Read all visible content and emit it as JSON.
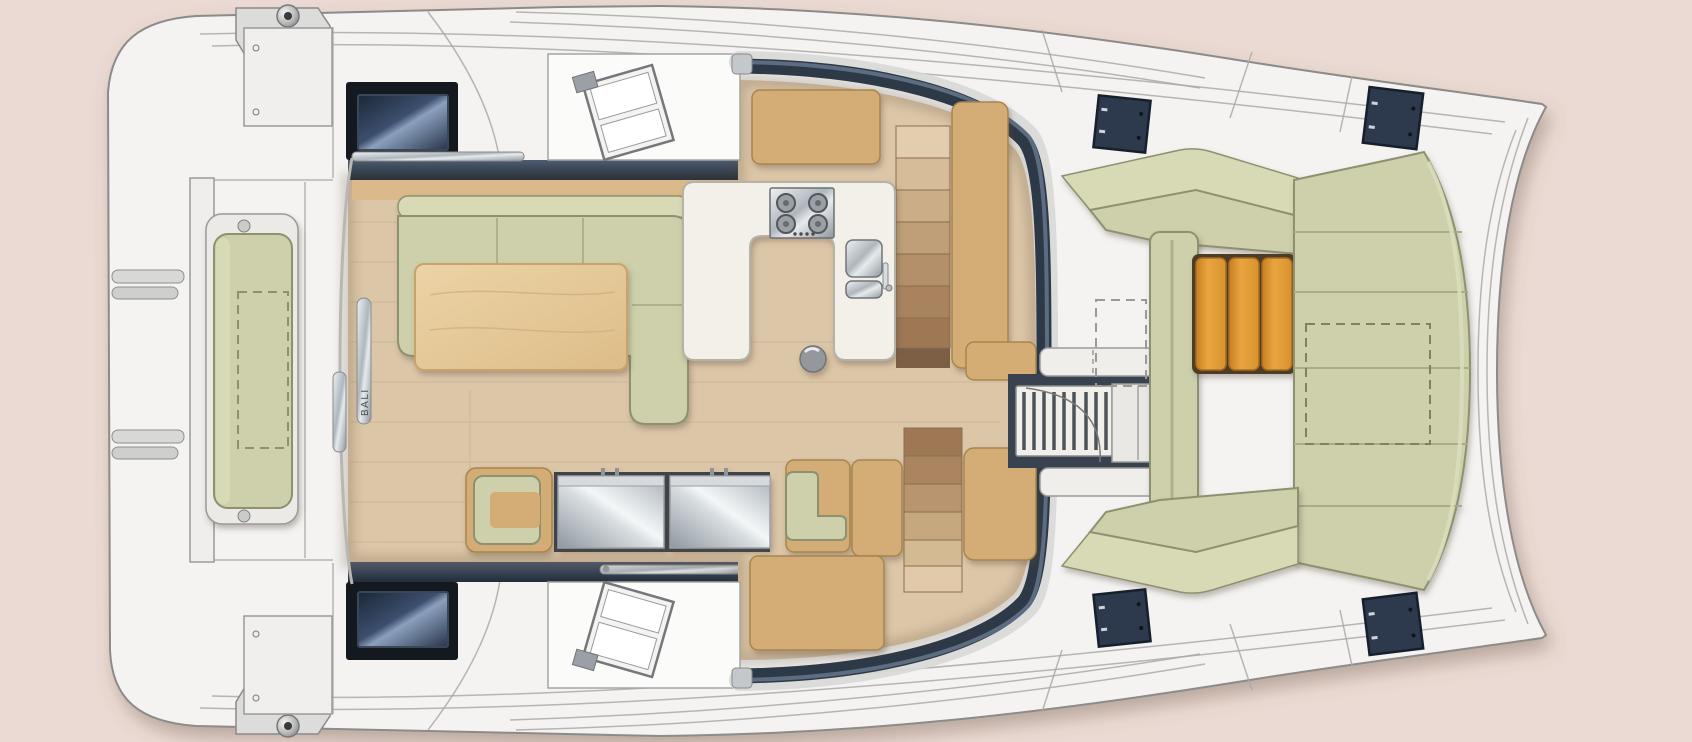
{
  "meta": {
    "kind": "catamaran-deck-floor-plan",
    "view": "top-down"
  },
  "branding": {
    "hull_label": "BALI"
  },
  "colors": {
    "background": "#ebdad3",
    "hull": "#f4f3f1",
    "deck-line": "#8f8f8d",
    "cabin-top-white": "#fbfbf9",
    "cushion": "#cdd0ab",
    "cushion-light": "#d8dab6",
    "cushion-edge": "#8e9170",
    "floor-wood": "#dcc6a8",
    "plank-line": "#c2a987",
    "cabinet": "#d3ad74",
    "cabinet-edge": "#a8854e",
    "counter": "#f2f0e9",
    "counter-edge": "#b5b2a6",
    "teak": "#d8922f",
    "teak-edge": "#a96c1d",
    "oak": "#e8cb9b",
    "dark-trim": "#2e3948",
    "window-pane": "#31405a",
    "window-frame": "#14181f",
    "metal": "#c9ced3",
    "stair-light": "#e2ceae",
    "stair-dark": "#9a7a5c"
  },
  "galley": {
    "stove_burners": 4,
    "sink_basins": 2
  },
  "stairs": {
    "starboard_steps": 7,
    "port_steps": 6
  }
}
